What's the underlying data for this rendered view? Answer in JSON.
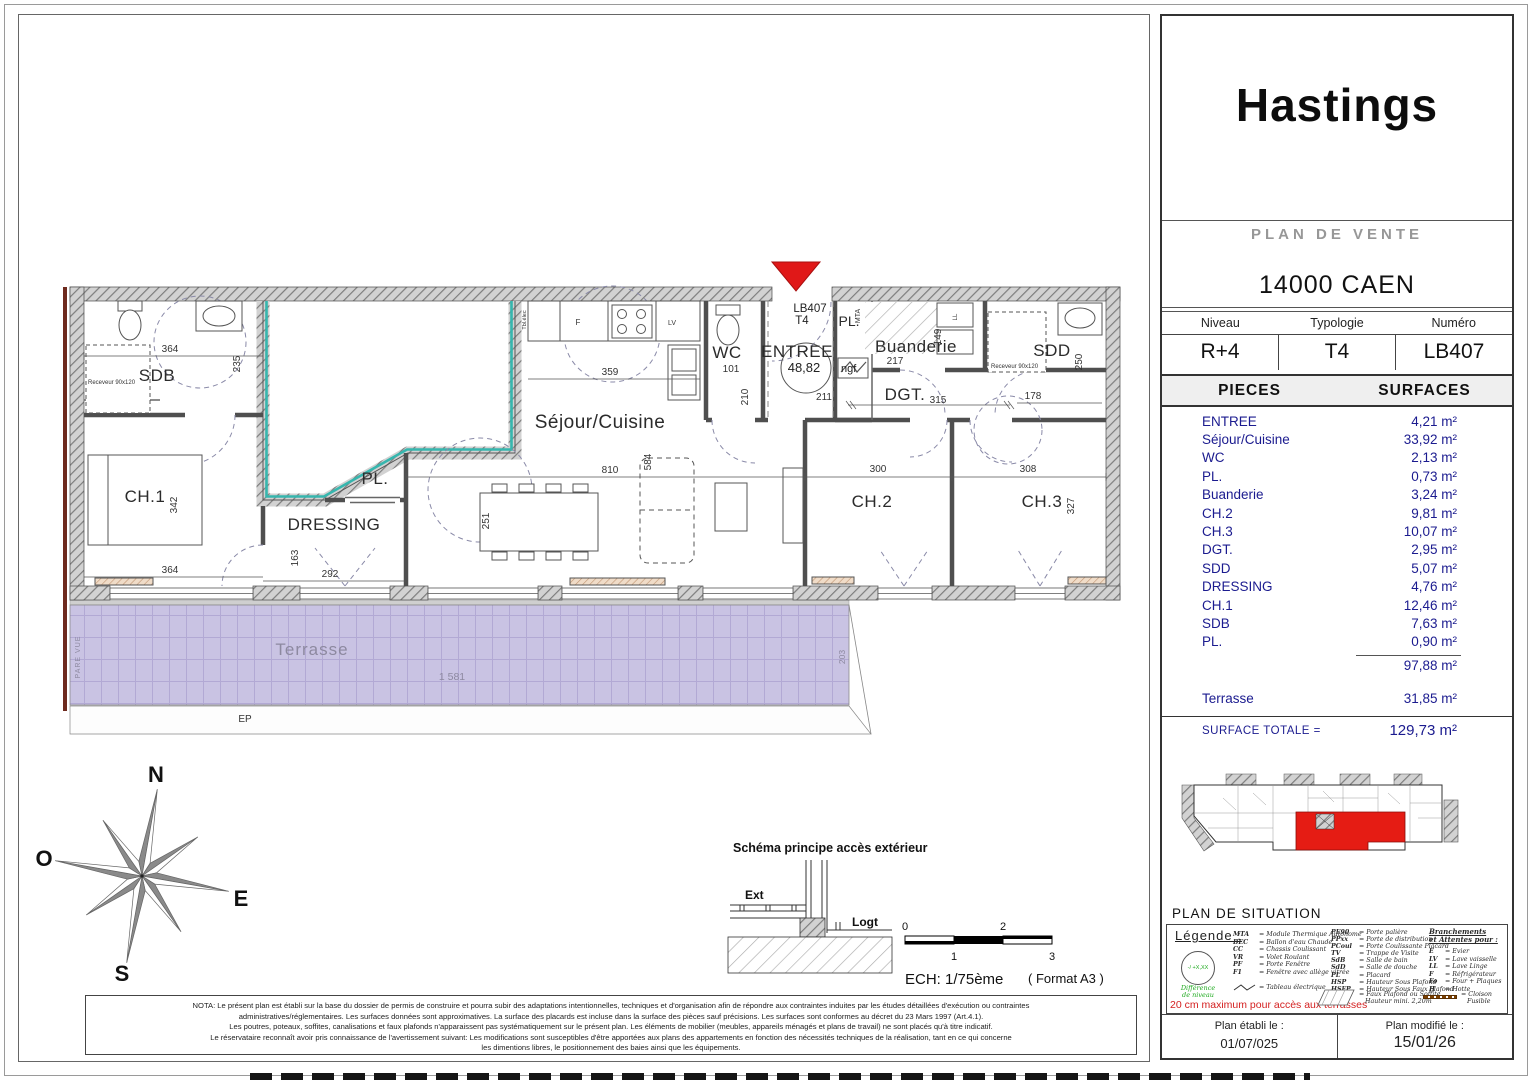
{
  "plan": {
    "rooms": {
      "sdb": "SDB",
      "ch1": "CH.1",
      "dressing": "DRESSING",
      "pl_dressing": "PL.",
      "sejour": "Séjour/Cuisine",
      "wc": "WC",
      "entree": "ENTREE",
      "pl_entree": "PL.",
      "buanderie": "Buanderie",
      "dgt": "DGT.",
      "sdd": "SDD",
      "ch2": "CH.2",
      "ch3": "CH.3",
      "terrasse": "Terrasse"
    },
    "unit": {
      "code": "LB407",
      "type": "T4",
      "ngf_value": "48,82",
      "ngf_unit": "ngf"
    },
    "dims": {
      "sdb_w": "364",
      "sdb_h": "235",
      "ch1_h": "342",
      "ch1_w": "364",
      "dressing_h": "163",
      "dressing_w": "292",
      "kitchen_w": "359",
      "sejour_h": "584",
      "sejour_w": "810",
      "table_d": "251",
      "wc_w": "101",
      "wc_h": "210",
      "entree_w": "211",
      "buanderie_w": "217",
      "buanderie_h": "149",
      "dgt_w": "315",
      "dgt_r": "178",
      "sdd_h": "250",
      "ch2_w": "300",
      "ch3_w": "308",
      "ch3_h": "327",
      "terrasse_w": "1 581",
      "terrasse_h": "203"
    },
    "annotations": {
      "receveur_sdb": "Receveur 90x120",
      "receveur_sdd": "Receveur 90x120",
      "mta": "MTA",
      "tbl_elec": "Tbl.élec",
      "frigo": "F",
      "lave_vaisselle": "LV",
      "lave_linge": "LL",
      "pare_vue": "PARE VUE",
      "ep_top": "EP",
      "ep_bottom": "EP"
    }
  },
  "compass": {
    "n": "N",
    "s": "S",
    "e": "E",
    "o": "O"
  },
  "schema": {
    "title": "Schéma principe accès extérieur",
    "ext": "Ext",
    "logt": "Logt"
  },
  "scalebar": {
    "t0": "0",
    "t1": "1",
    "t2": "2",
    "t3": "3",
    "ech": "ECH:  1/75ème",
    "format": "( Format A3 )"
  },
  "nota": {
    "l1": "NOTA: Le présent plan est établi sur la base du dossier de permis de construire et pourra subir des adaptations intentionnelles, techniques et d'organisation afin de répondre aux contraintes induites par les études détaillées d'exécution ou contraintes",
    "l2": "administratives/réglementaires. Les surfaces données sont approximatives. La surface des placards est incluse dans la surface des pièces sauf précisions. Les surfaces sont conformes au décret du 23 Mars 1997 (Art.4.1).",
    "l3": "Les poutres, poteaux, soffites, canalisations et faux plafonds n'apparaissent pas systématiquement sur le présent plan. Les éléments de mobilier (meubles, appareils ménagés et plans de travail) ne sont placés qu'à titre indicatif.",
    "l4": "Le réservataire reconnaît avoir pris connaissance de l'avertissement suivant: Les modifications sont susceptibles d'être apportées aux plans des appartements en fonction des nécessités techniques de la réalisation, tant en ce qui concerne",
    "l5": "les dimentions libres, le positionnement des baies ainsi que les équipements."
  },
  "panel": {
    "title": "Hastings",
    "subtitle": "PLAN DE VENTE",
    "city": "14000 CAEN",
    "meta": {
      "niveau_label": "Niveau",
      "typologie_label": "Typologie",
      "numero_label": "Numéro",
      "niveau": "R+4",
      "typologie": "T4",
      "numero": "LB407"
    },
    "table": {
      "pieces": "PIECES",
      "surfaces": "SURFACES",
      "rows": [
        {
          "name": "ENTREE",
          "area": "4,21 m²"
        },
        {
          "name": "Séjour/Cuisine",
          "area": "33,92 m²"
        },
        {
          "name": "WC",
          "area": "2,13 m²"
        },
        {
          "name": "PL.",
          "area": "0,73 m²"
        },
        {
          "name": "Buanderie",
          "area": "3,24 m²"
        },
        {
          "name": "CH.2",
          "area": "9,81 m²"
        },
        {
          "name": "CH.3",
          "area": "10,07 m²"
        },
        {
          "name": "DGT.",
          "area": "2,95 m²"
        },
        {
          "name": "SDD",
          "area": "5,07 m²"
        },
        {
          "name": "DRESSING",
          "area": "4,76 m²"
        },
        {
          "name": "CH.1",
          "area": "12,46 m²"
        },
        {
          "name": "SDB",
          "area": "7,63 m²"
        },
        {
          "name": "PL.",
          "area": "0,90 m²"
        }
      ],
      "subtotal": "97,88 m²",
      "terrasse": {
        "name": "Terrasse",
        "area": "31,85 m²"
      },
      "total_label": "SURFACE TOTALE =",
      "total": "129,73 m²"
    },
    "situation_label": "PLAN DE SITUATION",
    "legend": {
      "title": "Légende :",
      "level_diff": {
        "circle": "-/ +X,XX",
        "line1": "Différence",
        "line2": "de niveau"
      },
      "terrace_note": "20 cm maximum pour accès aux terrasses",
      "col1": [
        {
          "k": "MTA",
          "v": "=  Module Thermique Autonome"
        },
        {
          "k": "BEC",
          "v": "=  Ballon d'eau Chaude"
        },
        {
          "k": "CC",
          "v": "=  Chassis Coulissant"
        },
        {
          "k": "VR",
          "v": "=  Volet Roulant"
        },
        {
          "k": "PF",
          "v": "=  Porte Fenêtre"
        },
        {
          "k": "F1",
          "v": "=  Fenêtre avec allège vitrée"
        }
      ],
      "elec": "=  Tableau électrique",
      "col2": [
        {
          "k": "PE90",
          "v": "= Porte palière"
        },
        {
          "k": "PPxx",
          "v": "= Porte de distribution"
        },
        {
          "k": "PCoul",
          "v": "= Porte Coulissante Placard"
        },
        {
          "k": "TV",
          "v": "= Trappe de Visite"
        },
        {
          "k": "SdB",
          "v": "= Salle de bain"
        },
        {
          "k": "SdD",
          "v": "= Salle de douche"
        },
        {
          "k": "PL",
          "v": "= Placard"
        },
        {
          "k": "HSP",
          "v": "= Hauteur Sous Plafond"
        },
        {
          "k": "HSFP",
          "v": "= Hauteur Sous Faux Plafond"
        }
      ],
      "faux_plafond": {
        "line1": "= Faux Plafond ou Soffite",
        "line2": "Hauteur mini. 2,20m"
      },
      "branch_title1": "Branchements",
      "branch_title2": "et Attentes pour :",
      "col3": [
        {
          "k": "E",
          "v": "= Evier"
        },
        {
          "k": "LV",
          "v": "= Lave vaisselle"
        },
        {
          "k": "LL",
          "v": "= Lave Linge"
        },
        {
          "k": "F",
          "v": "= Réfrigérateur"
        },
        {
          "k": "Fo",
          "v": "= Four + Plaques"
        },
        {
          "k": "H",
          "v": "= Hotte"
        }
      ],
      "cloison": {
        "line1": "= Cloison",
        "line2": "Fusible"
      }
    },
    "footer": {
      "etabli_label": "Plan établi le :",
      "etabli_date": "01/07/025",
      "modifie_label": "Plan modifié le :",
      "modifie_date": "15/01/26"
    }
  }
}
